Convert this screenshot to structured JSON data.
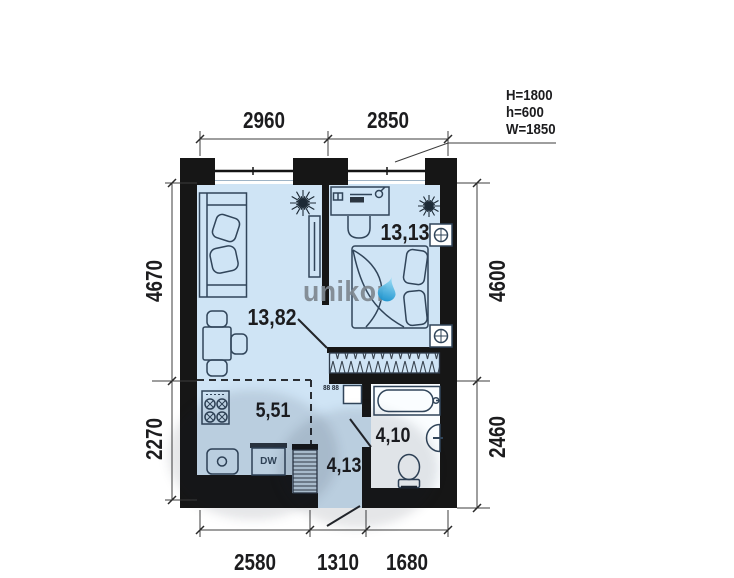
{
  "watermark": {
    "text": "unikor",
    "part1": "unik",
    "part2": "o",
    "part3": "r"
  },
  "window_spec": {
    "line1": "H=1800",
    "line2": "h=600",
    "line3": "W=1850"
  },
  "rooms": {
    "living": "13,82",
    "bedroom": "13,13",
    "kitchen": "5,51",
    "hall": "4,13",
    "bath": "4,10"
  },
  "dimensions": {
    "top": [
      "2960",
      "2850"
    ],
    "left": [
      "4670",
      "2270"
    ],
    "right": [
      "4600",
      "2460"
    ],
    "bottom": [
      "2580",
      "1310",
      "1680"
    ]
  },
  "appliances": {
    "dishwasher": "DW",
    "washer": "88 88"
  },
  "colors": {
    "floor": "#cfe4f5",
    "bathroom_floor": "#fafdff",
    "wall": "#161616",
    "furniture_line": "#31455a",
    "dim_text": "#1c1c1e",
    "watermark_gray": "#7e8790",
    "watermark_drop": "#2aa7dd"
  }
}
